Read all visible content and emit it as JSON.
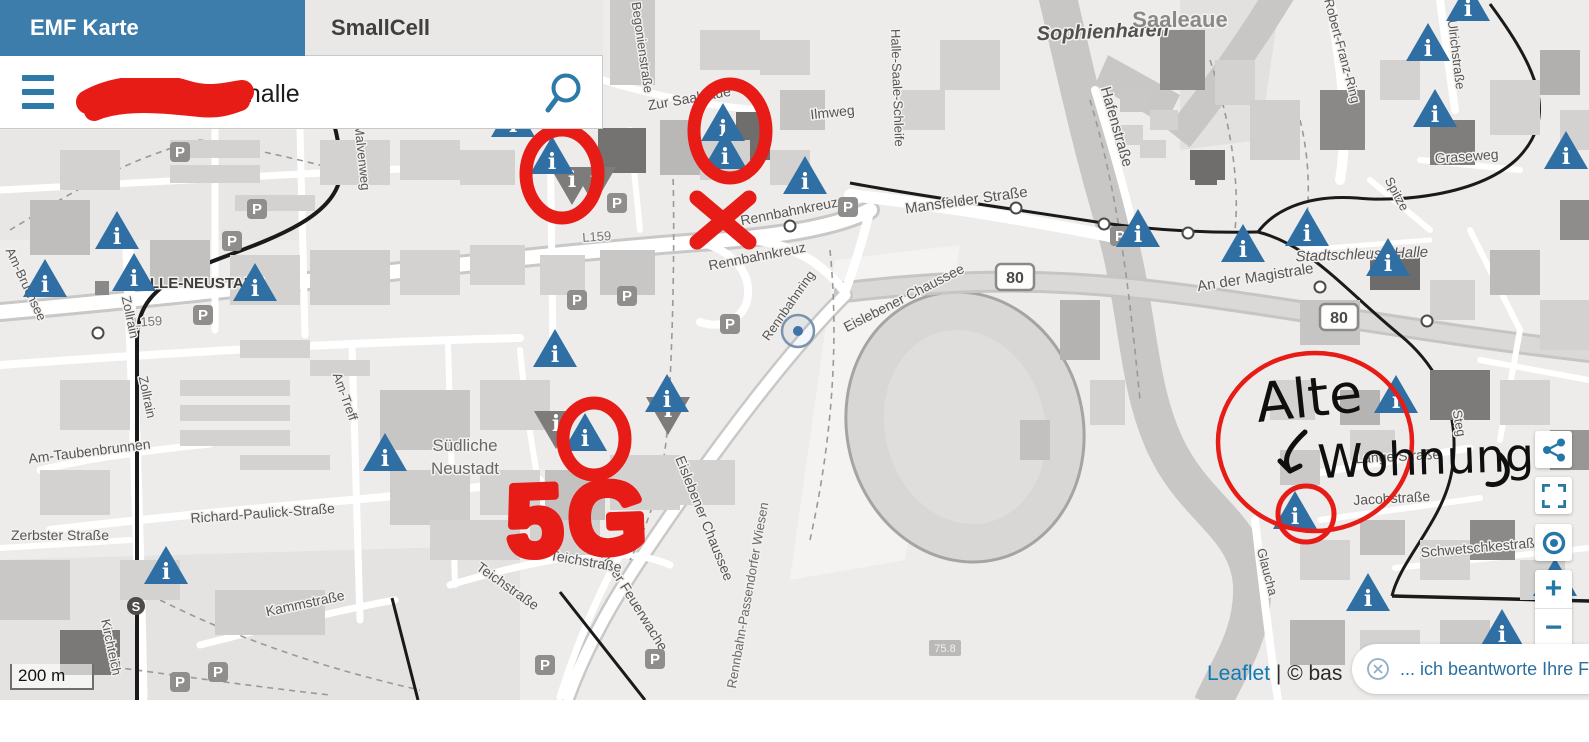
{
  "header": {
    "tabs": [
      {
        "label": "EMF Karte",
        "active": true
      },
      {
        "label": "SmallCell",
        "active": false
      }
    ],
    "search": {
      "visible_value": ", halle",
      "redacted_prefix": true
    }
  },
  "colors": {
    "tab_active_bg": "#3d7dab",
    "accent_blue": "#2d7aa8",
    "marker_blue": "#2f6fa4",
    "marker_gray": "#7d7c7a",
    "annotation_red": "#e71c17",
    "handwriting_black": "#0f0f0f",
    "link_blue": "#0f79b3",
    "label_gray": "#575655"
  },
  "controls": {
    "share": "share-icon",
    "fullscreen": "fullscreen-icon",
    "locate": "locate-icon",
    "zoom_in_label": "+",
    "zoom_out_label": "−"
  },
  "map": {
    "scale_label": "200 m",
    "attribution": {
      "leaflet_link": "Leaflet",
      "suffix": "| © bas"
    },
    "road_badges": [
      {
        "text": "80",
        "x": 1015,
        "y": 277
      },
      {
        "text": "80",
        "x": 1339,
        "y": 317
      }
    ],
    "small_badges": [
      {
        "text": "75.8",
        "x": 945,
        "y": 649
      }
    ],
    "sbahn_icon": {
      "text": "S",
      "x": 136,
      "y": 606
    },
    "location_circle": {
      "x": 798,
      "y": 331
    },
    "place_labels": [
      {
        "t": "Sophienhafen",
        "x": 1103,
        "y": 38,
        "r": -2,
        "s": 20,
        "c": "#525150",
        "fs": "italic",
        "fw": 700
      },
      {
        "t": "Saaleaue",
        "x": 1180,
        "y": 27,
        "r": 0,
        "s": 22,
        "c": "#8a8988",
        "fs": "normal",
        "fw": 700
      },
      {
        "t": "Hafenstraße",
        "x": 1112,
        "y": 128,
        "r": 74,
        "s": 15,
        "c": "#575655"
      },
      {
        "t": "Halle-Saale-Schleife",
        "x": 893,
        "y": 88,
        "r": 88,
        "s": 13,
        "c": "#575655"
      },
      {
        "t": "Zur Saaleaue",
        "x": 690,
        "y": 103,
        "r": -10,
        "s": 14,
        "c": "#575655"
      },
      {
        "t": "Ilmweg",
        "x": 833,
        "y": 117,
        "r": -6,
        "s": 14,
        "c": "#575655"
      },
      {
        "t": "Begonienstraße",
        "x": 638,
        "y": 48,
        "r": 82,
        "s": 13,
        "c": "#575655"
      },
      {
        "t": "Malvenweg",
        "x": 358,
        "y": 158,
        "r": 84,
        "s": 13,
        "c": "#575655"
      },
      {
        "t": "Mansfelder Straße",
        "x": 967,
        "y": 205,
        "r": -8,
        "s": 15,
        "c": "#575655"
      },
      {
        "t": "HALLE-NEUSTADT",
        "x": 196,
        "y": 288,
        "r": 0,
        "s": 15,
        "c": "#3c3c3b",
        "fw": 700
      },
      {
        "t": "L159",
        "x": 148,
        "y": 326,
        "r": -4,
        "s": 13,
        "c": "#767574"
      },
      {
        "t": "L159",
        "x": 597,
        "y": 241,
        "r": -4,
        "s": 13,
        "c": "#767574"
      },
      {
        "t": "Rennbahnkreuz",
        "x": 758,
        "y": 261,
        "r": -11,
        "s": 14,
        "c": "#575655"
      },
      {
        "t": "Rennbahnkreuz",
        "x": 790,
        "y": 216,
        "r": -11,
        "s": 14,
        "c": "#575655"
      },
      {
        "t": "Rennbahnring",
        "x": 792,
        "y": 308,
        "r": -55,
        "s": 13,
        "c": "#575655"
      },
      {
        "t": "Eislebener Chaussee",
        "x": 906,
        "y": 302,
        "r": -27,
        "s": 14,
        "c": "#575655"
      },
      {
        "t": "Eislebener Chaussee",
        "x": 700,
        "y": 520,
        "r": 68,
        "s": 14,
        "c": "#575655"
      },
      {
        "t": "An der Feuerwache",
        "x": 628,
        "y": 600,
        "r": 58,
        "s": 14,
        "c": "#575655"
      },
      {
        "t": "Rennbahn-Passendorfer Wiesen",
        "x": 752,
        "y": 596,
        "r": -80,
        "s": 13,
        "c": "#6a6968"
      },
      {
        "t": "An der Magistrale",
        "x": 1256,
        "y": 282,
        "r": -9,
        "s": 15,
        "c": "#575655"
      },
      {
        "t": "Stadtschleuse Halle",
        "x": 1362,
        "y": 259,
        "r": -2,
        "s": 15,
        "c": "#575655",
        "fs": "italic"
      },
      {
        "t": "Graseweg",
        "x": 1467,
        "y": 161,
        "r": -4,
        "s": 14,
        "c": "#575655"
      },
      {
        "t": "Spitze",
        "x": 1393,
        "y": 196,
        "r": 62,
        "s": 13,
        "c": "#575655"
      },
      {
        "t": "Robert-Franz-Ring",
        "x": 1338,
        "y": 52,
        "r": 75,
        "s": 13,
        "c": "#575655"
      },
      {
        "t": "Ulrichstraße",
        "x": 1452,
        "y": 55,
        "r": 83,
        "s": 13,
        "c": "#575655"
      },
      {
        "t": "Südliche",
        "x": 465,
        "y": 451,
        "r": 0,
        "s": 17,
        "c": "#6a6968"
      },
      {
        "t": "Neustadt",
        "x": 465,
        "y": 474,
        "r": 0,
        "s": 17,
        "c": "#6a6968"
      },
      {
        "t": "Richard-Paulick-Straße",
        "x": 263,
        "y": 518,
        "r": -4,
        "s": 14,
        "c": "#575655"
      },
      {
        "t": "Kammstraße",
        "x": 306,
        "y": 608,
        "r": -12,
        "s": 14,
        "c": "#575655"
      },
      {
        "t": "Teichstraße",
        "x": 505,
        "y": 590,
        "r": 35,
        "s": 14,
        "c": "#575655"
      },
      {
        "t": "Teichstraße",
        "x": 585,
        "y": 566,
        "r": 10,
        "s": 14,
        "c": "#575655"
      },
      {
        "t": "Zerbster Straße",
        "x": 60,
        "y": 540,
        "r": 0,
        "s": 14,
        "c": "#575655"
      },
      {
        "t": "Am-Taubenbrunnen",
        "x": 90,
        "y": 456,
        "r": -7,
        "s": 14,
        "c": "#575655"
      },
      {
        "t": "Zollrain",
        "x": 143,
        "y": 398,
        "r": 78,
        "s": 13,
        "c": "#575655"
      },
      {
        "t": "Zollrain",
        "x": 126,
        "y": 318,
        "r": 78,
        "s": 13,
        "c": "#575655"
      },
      {
        "t": "Am-Bruchsee",
        "x": 22,
        "y": 286,
        "r": 65,
        "s": 13,
        "c": "#575655"
      },
      {
        "t": "Am-Treff",
        "x": 341,
        "y": 398,
        "r": 70,
        "s": 13,
        "c": "#575655"
      },
      {
        "t": "Kirchteich",
        "x": 107,
        "y": 648,
        "r": 78,
        "s": 13,
        "c": "#575655"
      },
      {
        "t": "Schwetschkestraße",
        "x": 1482,
        "y": 552,
        "r": -5,
        "s": 14,
        "c": "#575655"
      },
      {
        "t": "Jacobstraße",
        "x": 1392,
        "y": 503,
        "r": -3,
        "s": 14,
        "c": "#575655"
      },
      {
        "t": "Lange Straße",
        "x": 1398,
        "y": 461,
        "r": -3,
        "s": 14,
        "c": "#575655"
      },
      {
        "t": "Steg",
        "x": 1455,
        "y": 424,
        "r": 80,
        "s": 13,
        "c": "#575655"
      },
      {
        "t": "Glaucha",
        "x": 1263,
        "y": 573,
        "r": 75,
        "s": 13,
        "c": "#575655"
      }
    ],
    "info_markers_blue": [
      [
        45,
        278
      ],
      [
        117,
        230
      ],
      [
        134,
        272
      ],
      [
        255,
        282
      ],
      [
        166,
        565
      ],
      [
        385,
        452
      ],
      [
        513,
        118
      ],
      [
        552,
        155
      ],
      [
        555,
        348
      ],
      [
        585,
        432
      ],
      [
        667,
        393
      ],
      [
        723,
        122
      ],
      [
        725,
        150
      ],
      [
        805,
        175
      ],
      [
        1138,
        228
      ],
      [
        1243,
        243
      ],
      [
        1307,
        227
      ],
      [
        1388,
        257
      ],
      [
        1396,
        394
      ],
      [
        1295,
        510
      ],
      [
        1368,
        592
      ],
      [
        1502,
        628
      ],
      [
        1555,
        577
      ],
      [
        1428,
        42
      ],
      [
        1435,
        108
      ],
      [
        1566,
        150
      ],
      [
        1468,
        2
      ]
    ],
    "info_markers_gray": [
      [
        572,
        186
      ],
      [
        594,
        186
      ],
      [
        556,
        430
      ],
      [
        668,
        416
      ]
    ],
    "parking_icons": [
      [
        188,
        12
      ],
      [
        180,
        152
      ],
      [
        257,
        209
      ],
      [
        232,
        241
      ],
      [
        203,
        315
      ],
      [
        617,
        203
      ],
      [
        577,
        300
      ],
      [
        627,
        296
      ],
      [
        730,
        324
      ],
      [
        848,
        207
      ],
      [
        1120,
        236
      ],
      [
        545,
        665
      ],
      [
        655,
        659
      ],
      [
        180,
        682
      ],
      [
        218,
        672
      ]
    ],
    "transit_stops": [
      [
        790,
        226
      ],
      [
        1016,
        208
      ],
      [
        1104,
        224
      ],
      [
        1188,
        233
      ],
      [
        1320,
        287
      ],
      [
        1427,
        321
      ],
      [
        98,
        333
      ]
    ]
  },
  "annotations": {
    "red_circles": [
      {
        "cx": 562,
        "cy": 174,
        "rx": 36,
        "ry": 44,
        "w": 13
      },
      {
        "cx": 730,
        "cy": 131,
        "rx": 36,
        "ry": 47,
        "w": 13
      },
      {
        "cx": 594,
        "cy": 439,
        "rx": 31,
        "ry": 36,
        "w": 13
      },
      {
        "cx": 1315,
        "cy": 442,
        "rx": 97,
        "ry": 89,
        "w": 4.5
      },
      {
        "cx": 1306,
        "cy": 514,
        "rx": 28,
        "ry": 28,
        "w": 5
      }
    ],
    "red_x": {
      "cx": 723,
      "cy": 220,
      "dx": 26,
      "dy": 22,
      "w": 15
    },
    "red_text": {
      "text": "5G",
      "x": 508,
      "y": 556,
      "size": 100,
      "rot": -2
    },
    "handwriting": {
      "word1": "Alte",
      "word2": "Wohnung",
      "arrow": "down-left-arrow"
    }
  },
  "chat": {
    "text": "... ich beantworte Ihre Fragen!"
  }
}
